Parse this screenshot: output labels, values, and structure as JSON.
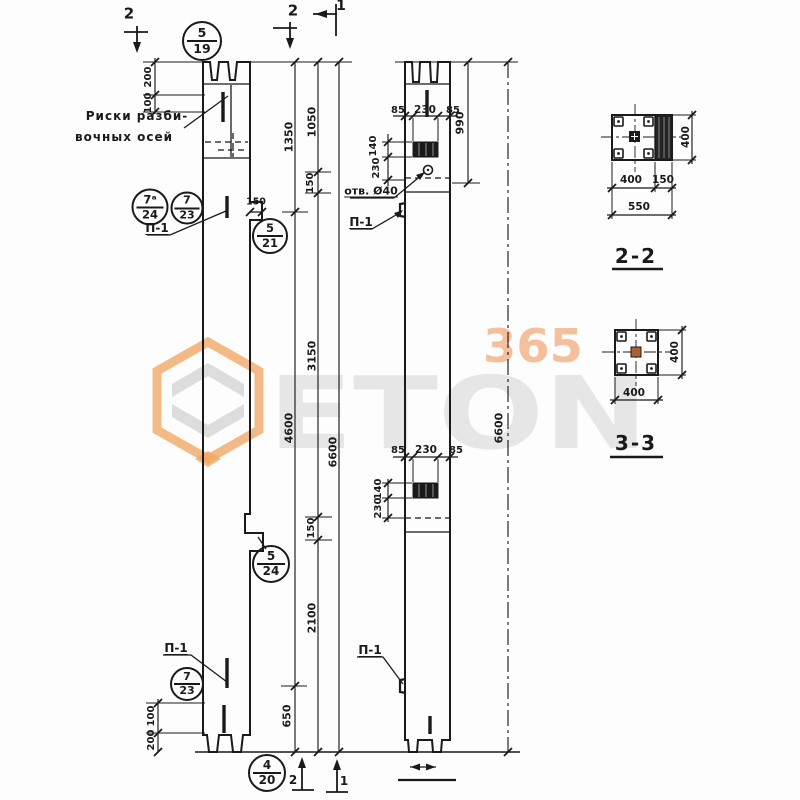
{
  "watermark": {
    "word": "ETON",
    "digits": "365"
  },
  "colors": {
    "ink": "#1a1a1a",
    "hex_orange": "#f0a35e",
    "digits_orange": "#f3b082",
    "word_gray": "#e5e5e5"
  },
  "notes": {
    "axis_line1": "Риски разби-",
    "axis_line2": "вочных осей",
    "hole": "отв. Ø40",
    "p_top_left": "П-1",
    "p_top_mid": "П-1",
    "p_bot_left": "П-1",
    "p_bot_mid": "П-1"
  },
  "marks": {
    "top_left": "2",
    "top_mid": "2",
    "top_right": "1",
    "bottom_left": "2",
    "bottom_right": "1"
  },
  "callouts": {
    "c1": {
      "num": "5",
      "sheet": "19"
    },
    "c2": {
      "num": "7ᵃ",
      "sheet": "24"
    },
    "c3": {
      "num": "7",
      "sheet": "23"
    },
    "c4": {
      "num": "5",
      "sheet": "21"
    },
    "c5": {
      "num": "5",
      "sheet": "24"
    },
    "c6": {
      "num": "7",
      "sheet": "23"
    },
    "c7": {
      "num": "4",
      "sheet": "20"
    }
  },
  "dims": {
    "d200t": "200",
    "d100t": "100",
    "d1350": "1350",
    "d1050": "1050",
    "d150a": "150",
    "d150step": "150",
    "d3150": "3150",
    "d4600": "4600",
    "d6600a": "6600",
    "d150b": "150",
    "d2100": "2100",
    "d650": "650",
    "d100b": "100",
    "d200b": "200",
    "d85tl": "85",
    "d230t": "230",
    "d85tr": "85",
    "d140t": "140",
    "d230tv": "230",
    "d990": "990",
    "d6600b": "6600",
    "d85bl": "85",
    "d230b": "230",
    "d85br": "85",
    "d140b": "140",
    "d230bv": "230"
  },
  "sections": {
    "s22": {
      "title": "2-2",
      "width": "400",
      "console": "150",
      "total": "550",
      "height": "400"
    },
    "s33": {
      "title": "3-3",
      "width": "400",
      "height": "400"
    }
  }
}
